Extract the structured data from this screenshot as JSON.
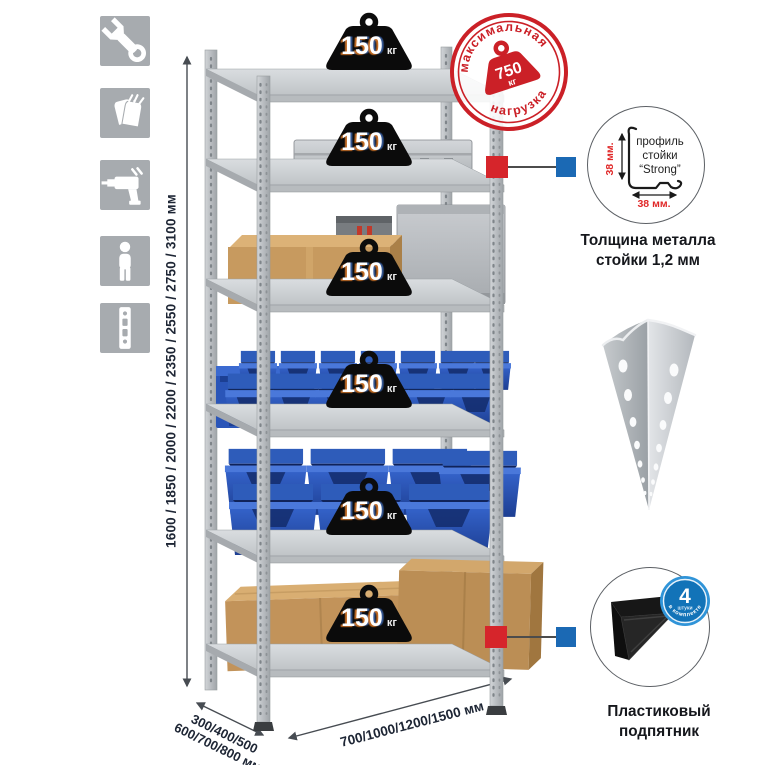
{
  "sidebar_icons": [
    {
      "name": "wrench-icon"
    },
    {
      "name": "gloves-icon"
    },
    {
      "name": "drill-icon"
    },
    {
      "name": "person-icon"
    },
    {
      "name": "rack-post-icon"
    }
  ],
  "dimensions": {
    "height": "1600 / 1850 / 2000 / 2200 / 2350 / 2550 / 2750 / 3100 мм",
    "depth_line1": "300/400/500",
    "depth_line2": "600/700/800 мм",
    "width": "700/1000/1200/1500 мм"
  },
  "rack": {
    "shelf_count": 6,
    "shelf_loads": [
      {
        "value": "150",
        "unit": "кг"
      },
      {
        "value": "150",
        "unit": "кг"
      },
      {
        "value": "150",
        "unit": "кг"
      },
      {
        "value": "150",
        "unit": "кг"
      },
      {
        "value": "150",
        "unit": "кг"
      },
      {
        "value": "150",
        "unit": "кг"
      }
    ]
  },
  "max_load_stamp": {
    "arc_top": "максимальная",
    "arc_bottom": "нагрузка",
    "value": "750",
    "unit": "кг"
  },
  "profile_detail": {
    "line1": "профиль",
    "line2": "стойки",
    "line3": "“Strong”",
    "dim_v": "38 мм.",
    "dim_h": "38 мм.",
    "caption1": "Толщина металла",
    "caption2": "стойки 1,2 мм"
  },
  "foot_detail": {
    "badge_number": "4",
    "badge_small": "штуки",
    "badge_arc": "в комплекте",
    "caption1": "Пластиковый",
    "caption2": "подпятник"
  },
  "colors": {
    "stamp_red": "#cb2027",
    "marker_red": "#d6252b",
    "marker_blue": "#1b69b4",
    "badge_blue": "#1273b8",
    "bin_blue": "#2d5cc4",
    "dim_text": "#1d2534"
  }
}
